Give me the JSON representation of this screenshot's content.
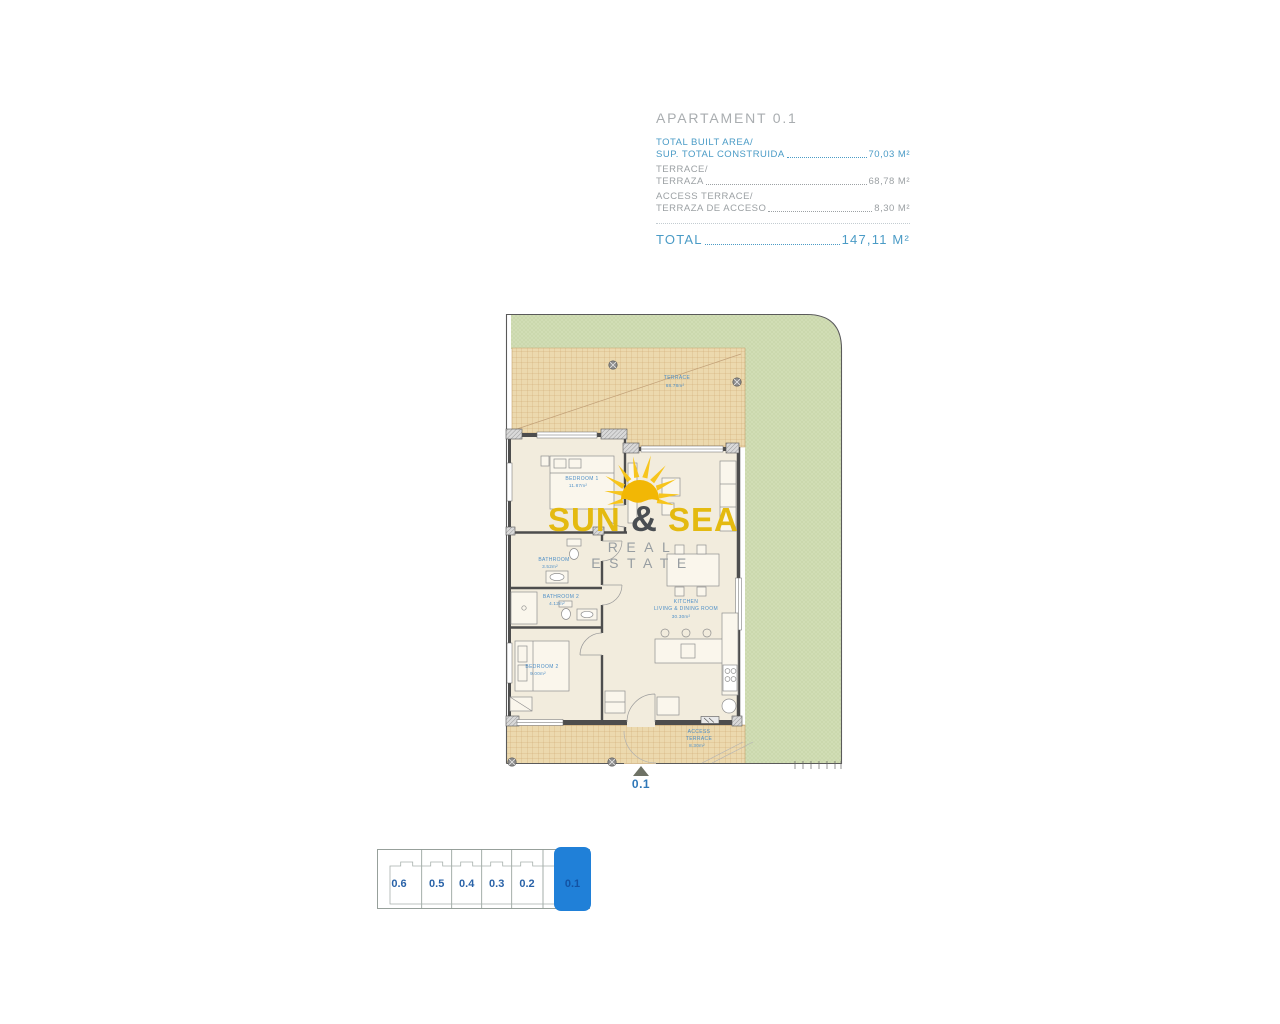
{
  "header": {
    "title": "APARTAMENT 0.1",
    "rows": [
      {
        "line1": "TOTAL BUILT AREA/",
        "line2": "SUP. TOTAL CONSTRUIDA",
        "value": "70,03 M²"
      },
      {
        "line1": "TERRACE/",
        "line2": "TERRAZA",
        "value": "68,78 M²"
      },
      {
        "line1": "ACCESS TERRACE/",
        "line2": "TERRAZA DE ACCESO",
        "value": "8,30 M²"
      }
    ],
    "total_label": "TOTAL",
    "total_value": "147,11 M²"
  },
  "plan": {
    "rooms": {
      "terrace": {
        "name": "TERRACE",
        "area": "68.78m²"
      },
      "bedroom1": {
        "name": "BEDROOM 1",
        "area": "11.87m²"
      },
      "bathroom1": {
        "name": "BATHROOM",
        "area": "3.52m²"
      },
      "bathroom2": {
        "name": "BATHROOM 2",
        "area": "4.12m²"
      },
      "bedroom2": {
        "name": "BEDROOM 2",
        "area": "9.00m²"
      },
      "kitchen": {
        "name1": "KITCHEN",
        "name2": "LIVING & DINING ROOM",
        "area": "30.30m²"
      },
      "access_terrace": {
        "name1": "ACCESS",
        "name2": "TERRACE",
        "area": "8.30m²"
      }
    },
    "entrance_label": "0.1"
  },
  "logo": {
    "word1": "SUN",
    "amp": "&",
    "word2": "SEA",
    "tagline": "REAL ESTATE"
  },
  "unit_selector": {
    "units": [
      "0.6",
      "0.5",
      "0.4",
      "0.3",
      "0.2",
      "0.1"
    ],
    "selected": "0.1"
  },
  "colors": {
    "accent_blue": "#2080d8",
    "text_blue": "#4a9bc6",
    "text_gray": "#9ca1a4",
    "logo_yellow": "#e4ba10",
    "lawn_green": "#d1ddb5",
    "terrace_tan": "#ecd9ae"
  }
}
